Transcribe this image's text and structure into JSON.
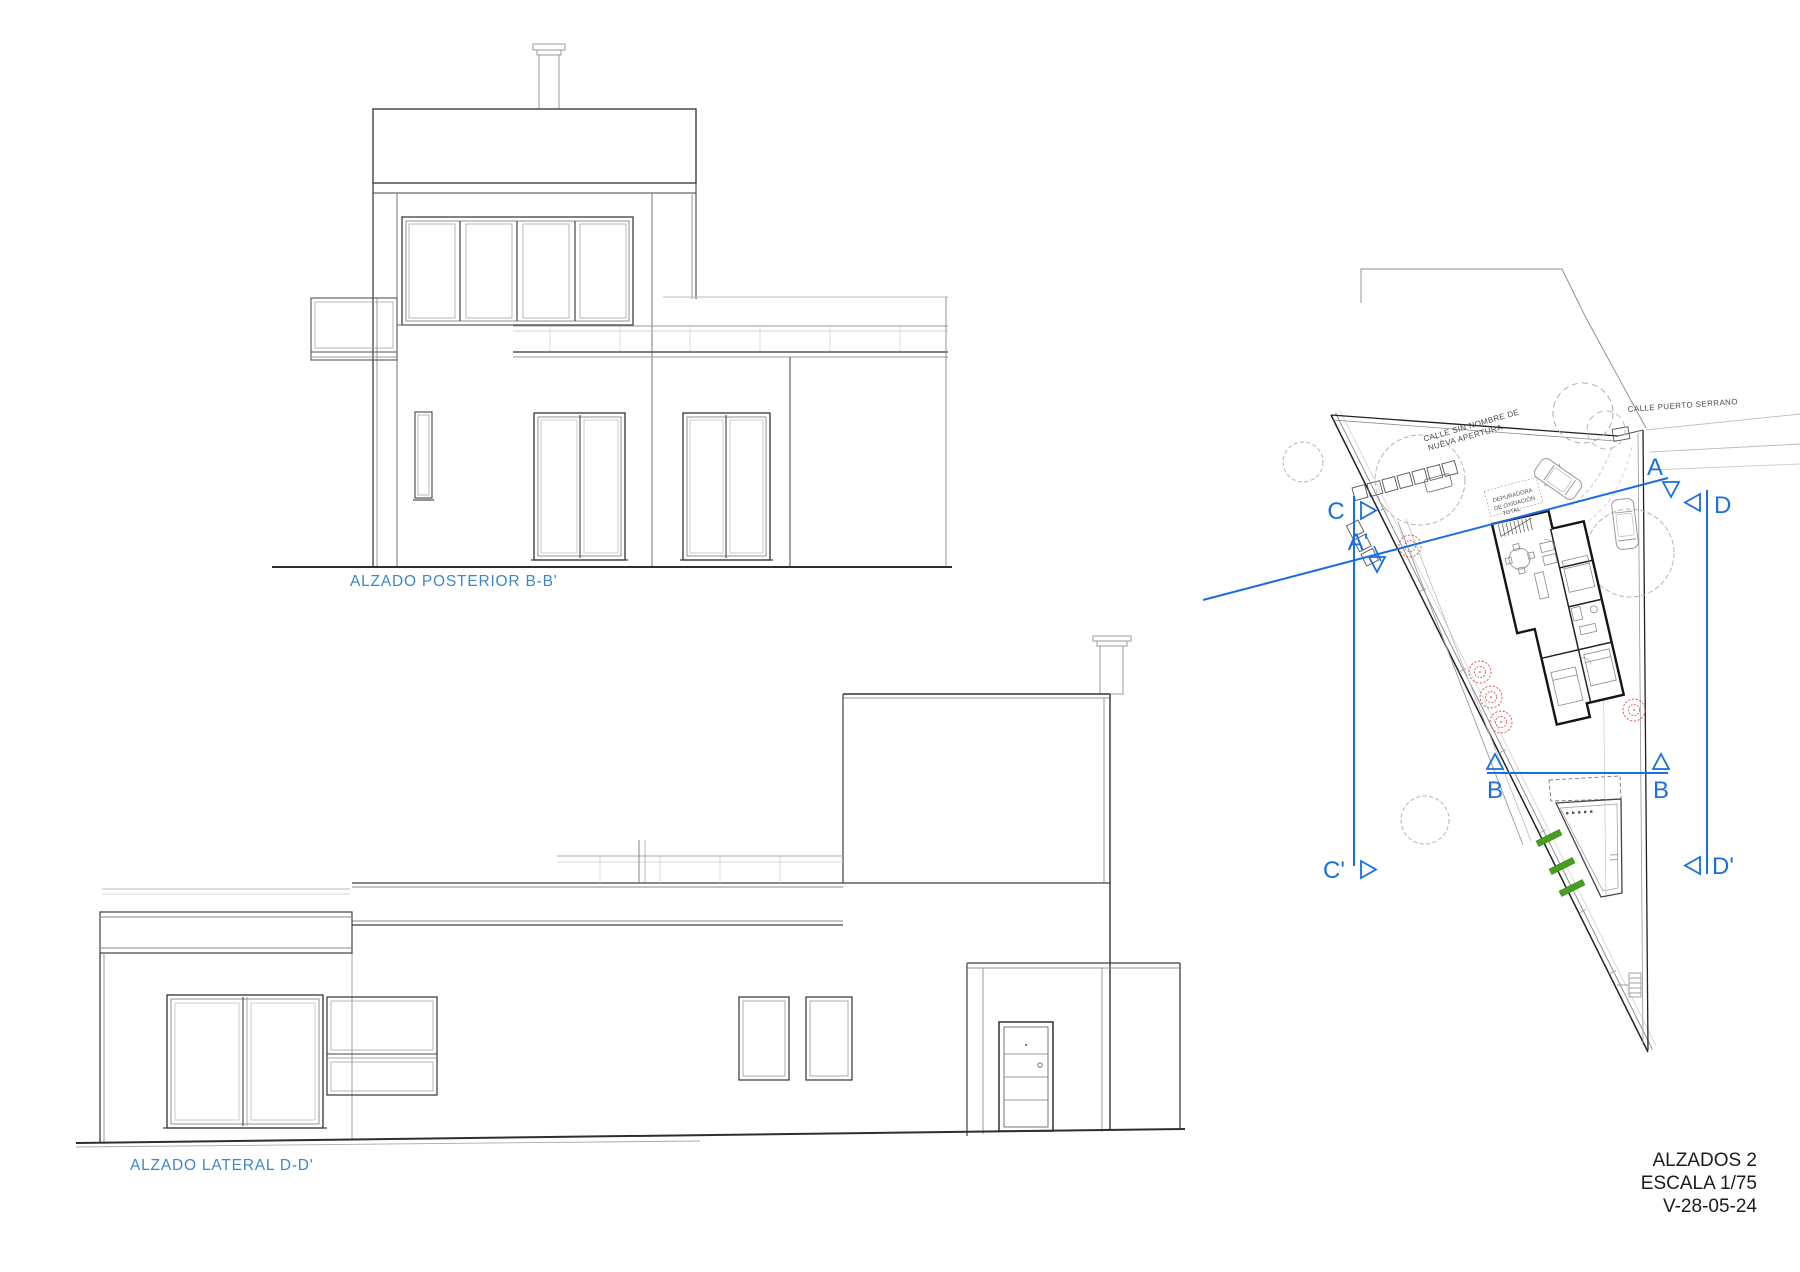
{
  "page": {
    "background": "#ffffff"
  },
  "colors": {
    "section_blue": "#1a6fe0",
    "label_blue": "#3c86cc",
    "line_dark": "#3a3a3a",
    "line_light": "#999999",
    "tree_red": "#dd4f4d",
    "hedge_green": "#44a01e"
  },
  "elevations": {
    "posterior": {
      "label": "ALZADO POSTERIOR B-B'"
    },
    "lateral": {
      "label": "ALZADO LATERAL D-D'"
    }
  },
  "site_plan": {
    "streets": {
      "street_top_line1": "CALLE SIN NOMBRE DE",
      "street_top_line2": "NUEVA APERTURA",
      "street_right": "CALLE PUERTO SERRANO"
    },
    "equipment_note": {
      "line1": "DEPURADORA",
      "line2": "DE OXIDACIÓN",
      "line3": "TOTAL"
    },
    "section_markers": {
      "a": "A",
      "a_prime": "A'",
      "b_left": "B",
      "b_right": "B",
      "c": "C",
      "c_prime": "C'",
      "d": "D",
      "d_prime": "D'"
    }
  },
  "title_block": {
    "sheet_title": "ALZADOS 2",
    "scale": "ESCALA 1/75",
    "version": "V-28-05-24"
  }
}
